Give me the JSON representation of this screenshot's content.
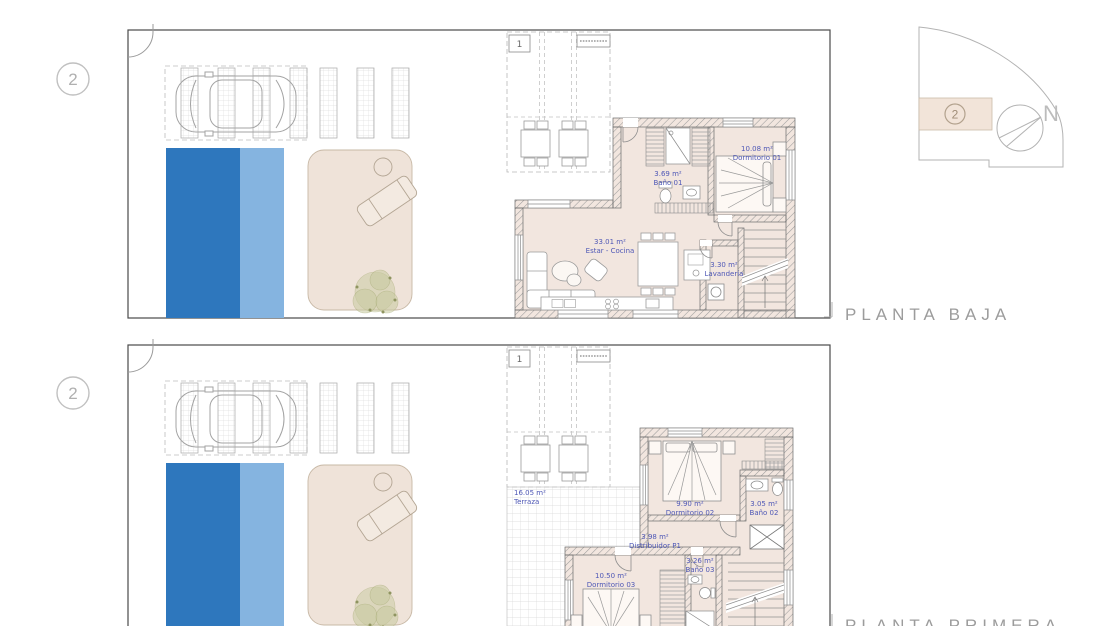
{
  "site_diagram": {
    "unit_marker": "2",
    "north_label": "N"
  },
  "plans": [
    {
      "id": "planta-baja",
      "caption": "PLANTA BAJA",
      "unit_marker": "2",
      "pergola_marker": "1",
      "rooms": [
        {
          "area": "3.69 m²",
          "name": "Baño 01"
        },
        {
          "area": "10.08 m²",
          "name": "Dormitorio 01"
        },
        {
          "area": "33.01 m²",
          "name": "Estar - Cocina"
        },
        {
          "area": "3.30 m²",
          "name": "Lavandería"
        }
      ]
    },
    {
      "id": "planta-primera",
      "caption": "PLANTA PRIMERA",
      "unit_marker": "2",
      "pergola_marker": "1",
      "rooms": [
        {
          "area": "16.05 m²",
          "name": "Terraza"
        },
        {
          "area": "9.90 m²",
          "name": "Dormitorio 02"
        },
        {
          "area": "3.05 m²",
          "name": "Baño 02"
        },
        {
          "area": "3.98 m²",
          "name": "Distribuidor P1"
        },
        {
          "area": "10.50 m²",
          "name": "Dormitorio 03"
        },
        {
          "area": "3.26 m²",
          "name": "Baño 03"
        }
      ]
    }
  ],
  "colors": {
    "pool_dark": "#2e77bd",
    "pool_light": "#85b4e0",
    "interior_floor": "#f2e6df",
    "terrace_beige": "#efe3d9",
    "room_label_blue": "#4f58b6",
    "caption_gray": "#9c9c9c"
  }
}
